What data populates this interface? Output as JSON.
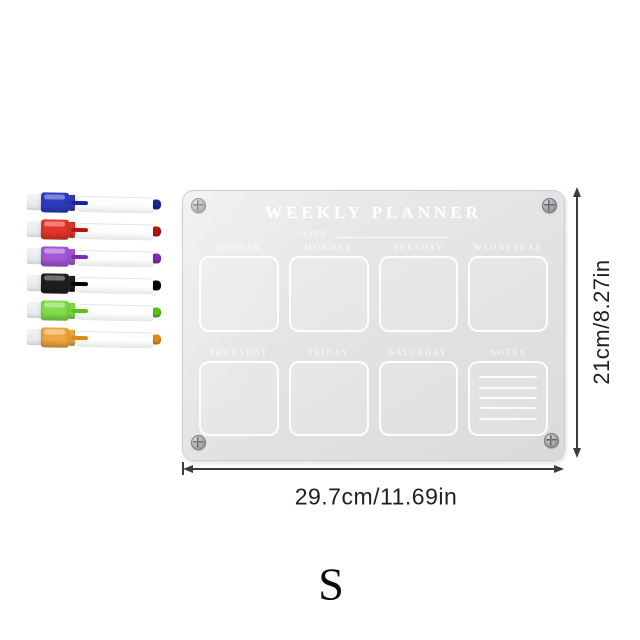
{
  "board": {
    "title": "WEEKLY PLANNER",
    "date_label": "DATE",
    "day_labels_row1": [
      "SUNDAY",
      "MONDAY",
      "TUESDAY",
      "WEDNESDAY"
    ],
    "day_labels_row2": [
      "THURSDAY",
      "FRIDAY",
      "SATURDAY"
    ],
    "notes_label": "NOTES",
    "notes_line_count": 5,
    "surface_color": "#e4e4e6",
    "engraving_color": "#ffffff"
  },
  "markers": [
    {
      "name": "blue",
      "cap_color": "#2e3bc0",
      "accent_color": "#18249a"
    },
    {
      "name": "red",
      "cap_color": "#e53428",
      "accent_color": "#b5170e"
    },
    {
      "name": "purple",
      "cap_color": "#a457d6",
      "accent_color": "#7d2ab8"
    },
    {
      "name": "black",
      "cap_color": "#1e1e20",
      "accent_color": "#000000"
    },
    {
      "name": "green",
      "cap_color": "#82dd4a",
      "accent_color": "#57c21e"
    },
    {
      "name": "orange",
      "cap_color": "#f0a73f",
      "accent_color": "#e18a12"
    }
  ],
  "dimension_annotations": {
    "height_label": "21cm/8.27in",
    "width_label": "29.7cm/11.69in",
    "line_color": "#3c3c3e"
  },
  "size_variant_label": "S"
}
